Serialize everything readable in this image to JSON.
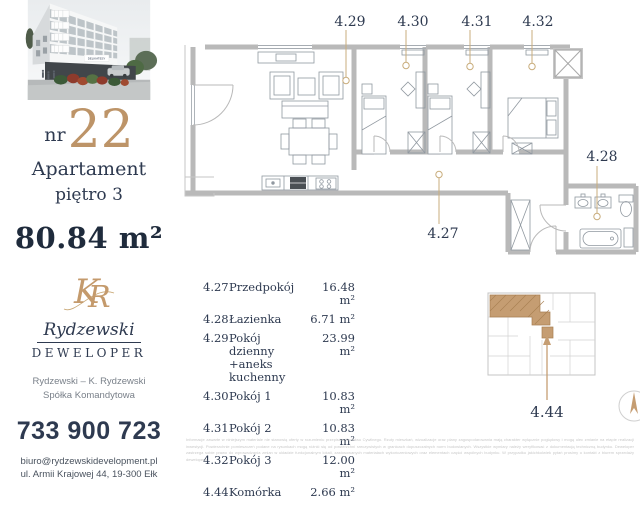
{
  "sidebar": {
    "photo": {
      "sign": "DELIKATESY"
    },
    "unit": {
      "prefix": "nr",
      "number": "22",
      "type": "Apartament",
      "floor": "piętro 3",
      "area": "80.84 m²"
    },
    "logo": {
      "monogram": "KR",
      "name": "Rydzewski",
      "tagline": "DEWELOPER"
    },
    "company": {
      "line1": "Rydzewski – K. Rydzewski",
      "line2": "Spółka Komandytowa"
    },
    "contact": {
      "phone": "733 900 723",
      "email": "biuro@rydzewskidevelopment.pl",
      "address": "ul. Armii Krajowej 44, 19-300 Ełk"
    }
  },
  "plan": {
    "labels": {
      "hall": "4.27",
      "bath": "4.28",
      "living": "4.29",
      "room1": "4.30",
      "room2": "4.31",
      "room3": "4.32"
    }
  },
  "rooms_table": {
    "rows": [
      {
        "no": "4.27",
        "name": "Przedpokój",
        "area": "16.48 m²"
      },
      {
        "no": "4.28",
        "name": "Łazienka",
        "area": "6.71 m²"
      },
      {
        "no": "4.29",
        "name": "Pokój dzienny\n+aneks kuchenny",
        "area": "23.99 m²"
      },
      {
        "no": "4.30",
        "name": "Pokój 1",
        "area": "10.83 m²"
      },
      {
        "no": "4.31",
        "name": "Pokój 2",
        "area": "10.83 m²"
      },
      {
        "no": "4.32",
        "name": "Pokój 3",
        "area": "12.00 m²"
      },
      {
        "no": "4.44",
        "name": "Komórka",
        "area": "2.66 m²"
      }
    ]
  },
  "key_plan": {
    "storage_label": "4.44"
  },
  "disclaimer": "Informacje zawarte w niniejszym materiale nie stanowią oferty w rozumieniu przepisów Kodeksu Cywilnego. Rzuty mieszkań, wizualizacje oraz plany zagospodarowania mają charakter wyłącznie poglądowy i mogą ulec zmianie na etapie realizacji inwestycji. Powierzchnie pomieszczeń podane na rysunkach mogą różnić się od powierzchni rzeczywistych w granicach dopuszczalnych norm budowlanych. Wszystkie wymiary należy weryfikować z dokumentacją techniczną budynku. Deweloper zastrzega sobie prawo do wprowadzania zmian w układzie funkcjonalnym lokali, zastosowanych materiałach wykończeniowych oraz elementach części wspólnych budynku. W przypadku jakichkolwiek pytań prosimy o kontakt z biurem sprzedaży dewelopera.",
  "colors": {
    "navy": "#2e3a50",
    "gold": "#bd9468",
    "leader": "#c9ad7c",
    "wall": "#b9b9b9"
  }
}
